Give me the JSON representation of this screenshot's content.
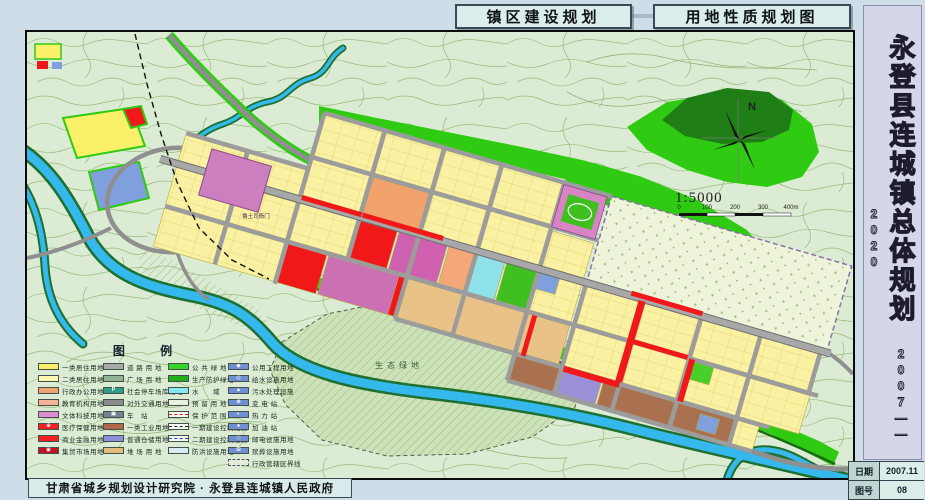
{
  "header": {
    "title_left": "镇区建设规划",
    "title_right": "用地性质规划图"
  },
  "sidebar": {
    "title_vertical": "永登县连城镇总体规划",
    "years": "2007——2020",
    "info": [
      {
        "label": "日期",
        "value": "2007.11"
      },
      {
        "label": "图号",
        "value": "08"
      }
    ]
  },
  "footer": {
    "credit": "甘肃省城乡规划设计研究院 · 永登县连城镇人民政府"
  },
  "map": {
    "labels": {
      "eco_green": "生态绿地",
      "yamen": "鲁土司衙门"
    },
    "north_label": "N",
    "scale_ratio": "1:5000",
    "scale_ticks": [
      "0",
      "100",
      "200",
      "300",
      "400m"
    ]
  },
  "legend": {
    "title": "图  例",
    "columns": [
      [
        {
          "label": "一类居住用地",
          "type": "fill",
          "color": "#F7EF6A"
        },
        {
          "label": "二类居住用地",
          "type": "fill",
          "color": "#FBF7B0"
        },
        {
          "label": "行政办公用地",
          "type": "fill",
          "color": "#F0A26E"
        },
        {
          "label": "教育机构用地",
          "type": "fill",
          "color": "#F5B49A"
        },
        {
          "label": "文体科技用地",
          "type": "fill",
          "color": "#DE8ED2"
        },
        {
          "label": "医疗保健用地",
          "type": "fill",
          "color": "#F52020",
          "glyph": "⊕"
        },
        {
          "label": "商业金融用地",
          "type": "fill",
          "color": "#F52020"
        },
        {
          "label": "集贸市场用地",
          "type": "fill",
          "color": "#C01425",
          "glyph": "◉"
        }
      ],
      [
        {
          "label": "道 路 用 地",
          "type": "fill",
          "color": "#A8A8A8"
        },
        {
          "label": "广 场 用 地",
          "type": "fill",
          "color": "#93B28F"
        },
        {
          "label": "社会停车场库用地",
          "type": "fill",
          "color": "#2F9E85",
          "glyph": "P"
        },
        {
          "label": "对外交通用地",
          "type": "fill",
          "color": "#8C8C8C"
        },
        {
          "label": "车　站",
          "type": "fill",
          "color": "#76828F",
          "glyph": "▣"
        },
        {
          "label": "一类工业用地",
          "type": "fill",
          "color": "#B06845"
        },
        {
          "label": "普通仓储用地",
          "type": "fill",
          "color": "#8E8EDC"
        },
        {
          "label": "堆 场 用 地",
          "type": "fill",
          "color": "#E3BE7E"
        }
      ],
      [
        {
          "label": "公 共 绿 地",
          "type": "fill",
          "color": "#35D52B"
        },
        {
          "label": "生产防护绿地",
          "type": "fill",
          "color": "#23AE1D"
        },
        {
          "label": "水　　域",
          "type": "fill",
          "color": "#86E7F5"
        },
        {
          "label": "预 留 用 地",
          "type": "fill",
          "color": "#EAF3E2"
        },
        {
          "label": "保 护 范 围",
          "type": "line",
          "color": "#E01818"
        },
        {
          "label": "一期建设控制范围",
          "type": "line",
          "color": "#222222"
        },
        {
          "label": "二期建设控制范围",
          "type": "line",
          "color": "#2244CC"
        },
        {
          "label": "防洪设施用地",
          "type": "fill",
          "color": "#D9ECF2"
        }
      ],
      [
        {
          "label": "公用工程用地",
          "type": "fill",
          "color": "#6F8FD2",
          "glyph": "◆"
        },
        {
          "label": "给水设施用地",
          "type": "fill",
          "color": "#6F8FD2",
          "glyph": "◎"
        },
        {
          "label": "污水处理设施",
          "type": "fill",
          "color": "#6F8FD2",
          "glyph": "▲"
        },
        {
          "label": "变 电 站",
          "type": "fill",
          "color": "#6F8FD2",
          "glyph": "⊗"
        },
        {
          "label": "热 力 站",
          "type": "fill",
          "color": "#6F8FD2",
          "glyph": "◐"
        },
        {
          "label": "加 油 站",
          "type": "fill",
          "color": "#6F8FD2",
          "glyph": "●"
        },
        {
          "label": "邮电设施用地",
          "type": "fill",
          "color": "#6F8FD2",
          "glyph": "◇"
        },
        {
          "label": "殡葬设施用地",
          "type": "fill",
          "color": "#6F8FD2",
          "glyph": "⊞"
        },
        {
          "label": "行政管辖区界线",
          "type": "fill",
          "color": "#E4EBDD",
          "dashedBorder": true
        }
      ]
    ]
  }
}
